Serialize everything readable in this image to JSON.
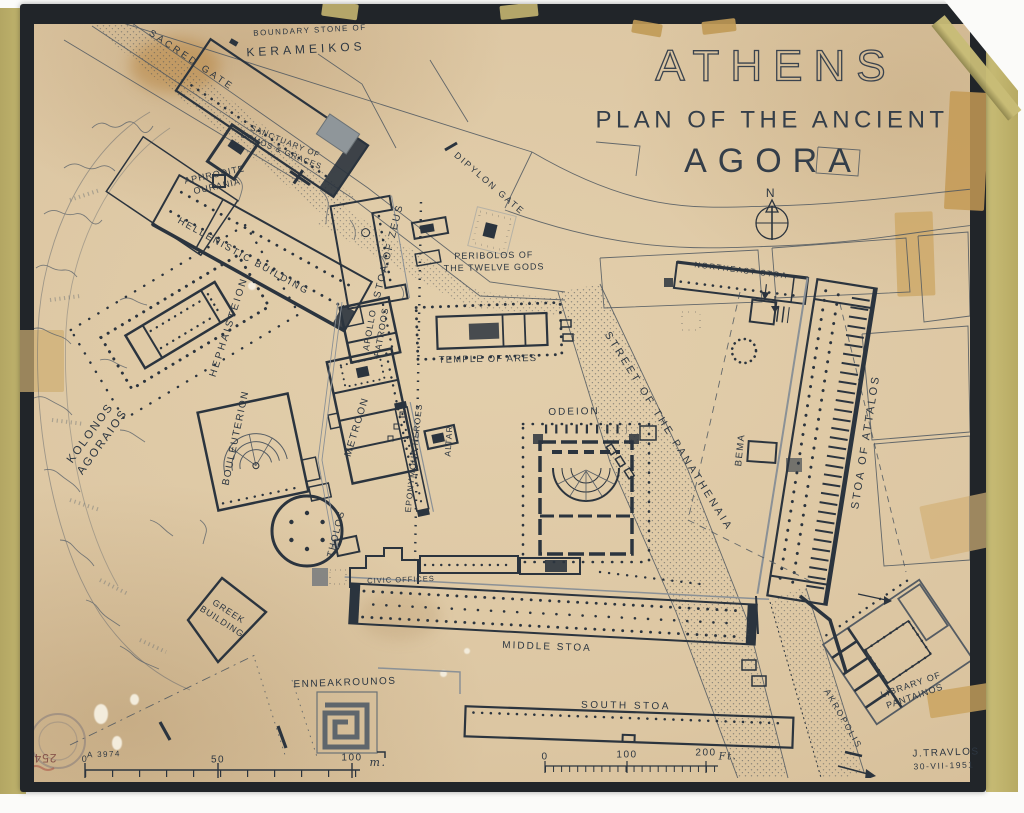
{
  "map": {
    "title": {
      "city": "ATHENS",
      "line2": "PLAN OF THE ANCIENT",
      "line3": "AGORA"
    },
    "north": "N",
    "labels": {
      "kerameikos_caption": "BOUNDARY STONE OF",
      "kerameikos": "KERAMEIKOS",
      "sacred_gate": "SACRED GATE",
      "sanctuary": "SANCTUARY OF\nDEMOS & GRACES",
      "aphrodite": "APHRODITE\nOURANIA",
      "hellenistic": "HELLENISTIC BUILDING",
      "hephaisteion": "HEPHAISTEION",
      "stoa_of_zeus": "STOA OF ZEUS",
      "apollo_patroos": "APOLLO\nPATROOS",
      "metroon": "METROON",
      "bouleuterion": "BOULEUTERION",
      "kolonos": "KOLONOS\nAGORAIOS",
      "dipylon_gate": "DIPYLON GATE",
      "peribolos": "PERIBOLOS OF\nTHE TWELVE GODS",
      "temple_of_ares": "TEMPLE OF ARES",
      "eponymous_heroes": "EPONYMOUS HEROES",
      "altar": "ALTAR",
      "odeion": "ODEION",
      "bema": "BEMA",
      "northeast_stoa": "NORTHEAST STOA",
      "stoa_of_attalos": "STOA OF ATTALOS",
      "panathenaia": "STREET OF THE PANATHENAIA",
      "tholos": "THOLOS",
      "greek_building": "GREEK\nBUILDING",
      "civic_offices": "CIVIC OFFICES",
      "middle_stoa": "MIDDLE STOA",
      "enneakrounos": "ENNEAKROUNOS",
      "south_stoa": "SOUTH STOA",
      "library": "LIBRARY OF\nPANTAINOS",
      "akropolis": "AKROPOLIS"
    },
    "scale_m": {
      "start": "0",
      "mid": "50",
      "end": "100",
      "unit": "m."
    },
    "scale_ft": {
      "start": "0",
      "mid": "100",
      "end": "200",
      "unit": "Ft."
    },
    "credit": {
      "author": "J.TRAVLOS",
      "date": "30-VII-1951"
    },
    "ref_number": "A 3974",
    "stamp_number": "254"
  },
  "colors": {
    "ink": "#2b343e",
    "paper": "#dcc6a2",
    "frame": "#212529",
    "edge_tape": "#c2b66f",
    "repair_tape": "#c9a25d",
    "stamp_red": "#7c4540"
  }
}
